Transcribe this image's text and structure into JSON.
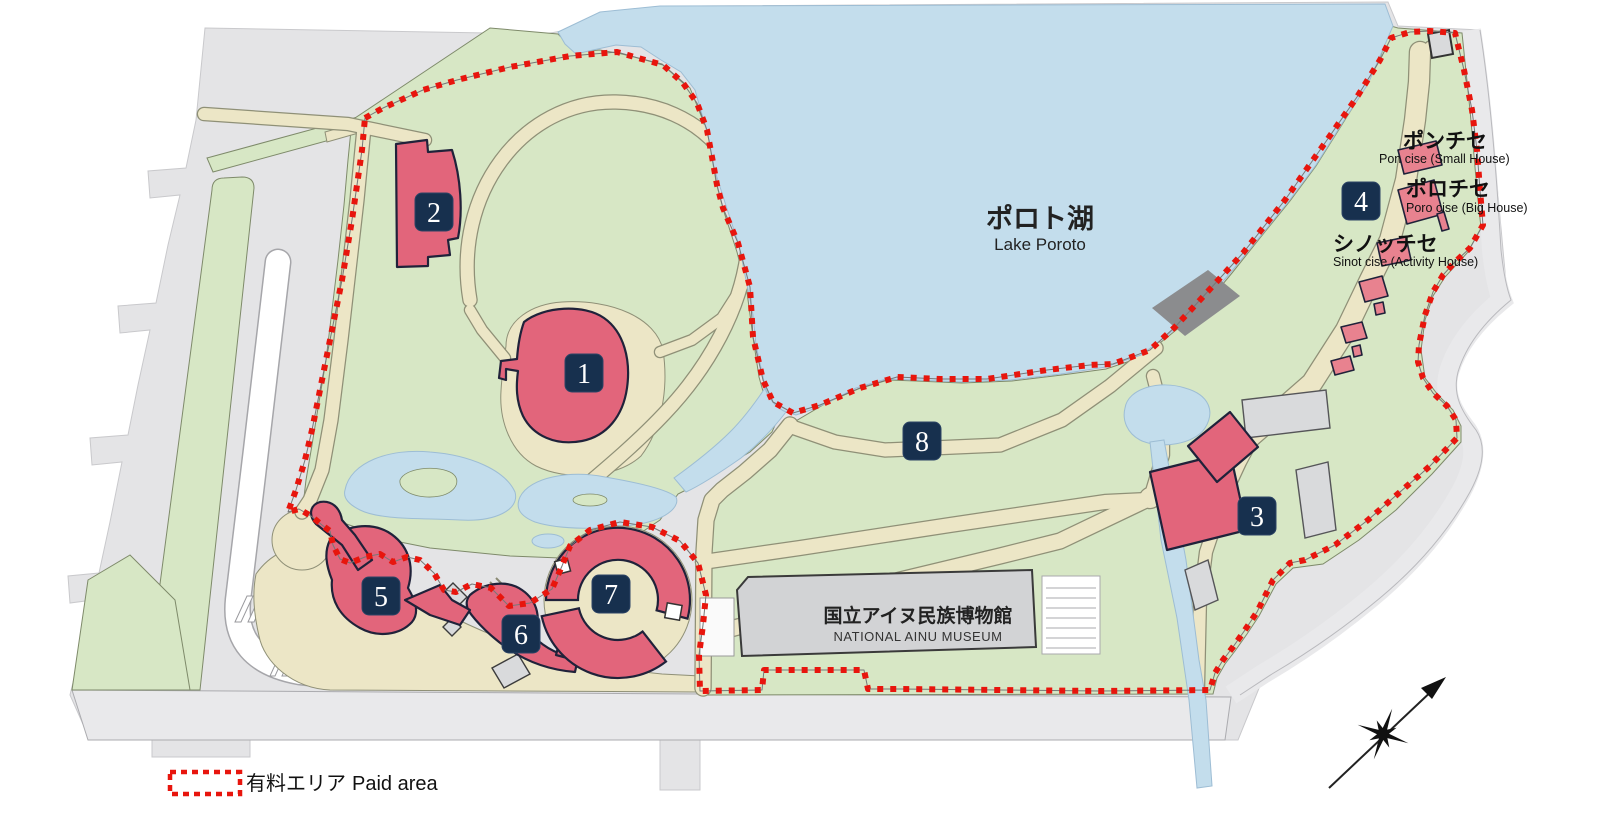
{
  "lake": {
    "jp": "ポロト湖",
    "en": "Lake Poroto"
  },
  "museum": {
    "jp": "国立アイヌ民族博物館",
    "en": "NATIONAL AINU MUSEUM"
  },
  "houses": [
    {
      "jp": "ポンチセ",
      "en": "Pon cise (Small House)"
    },
    {
      "jp": "ポロチセ",
      "en": "Poro cise (Big House)"
    },
    {
      "jp": "シノッチセ",
      "en": "Sinot cise (Activity House)"
    }
  ],
  "legend": {
    "jp": "有料エリア",
    "en": "Paid area"
  },
  "markers": [
    {
      "label": "1"
    },
    {
      "label": "2"
    },
    {
      "label": "3"
    },
    {
      "label": "4"
    },
    {
      "label": "5"
    },
    {
      "label": "6"
    },
    {
      "label": "7"
    },
    {
      "label": "8"
    }
  ],
  "colors": {
    "paid_area": "#e8150d",
    "water": "#c3ddec",
    "green": "#d7e7c5",
    "path": "#ece6c6",
    "building": "#e2657b",
    "building_light": "#e8828f",
    "marker_bg": "#17304e",
    "marker_text": "#ffffff",
    "outside": "#e4e4e6",
    "road": "#e9e9eb",
    "museum_gray": "#d2d3d5",
    "dark_gray": "#8b8c8e"
  }
}
